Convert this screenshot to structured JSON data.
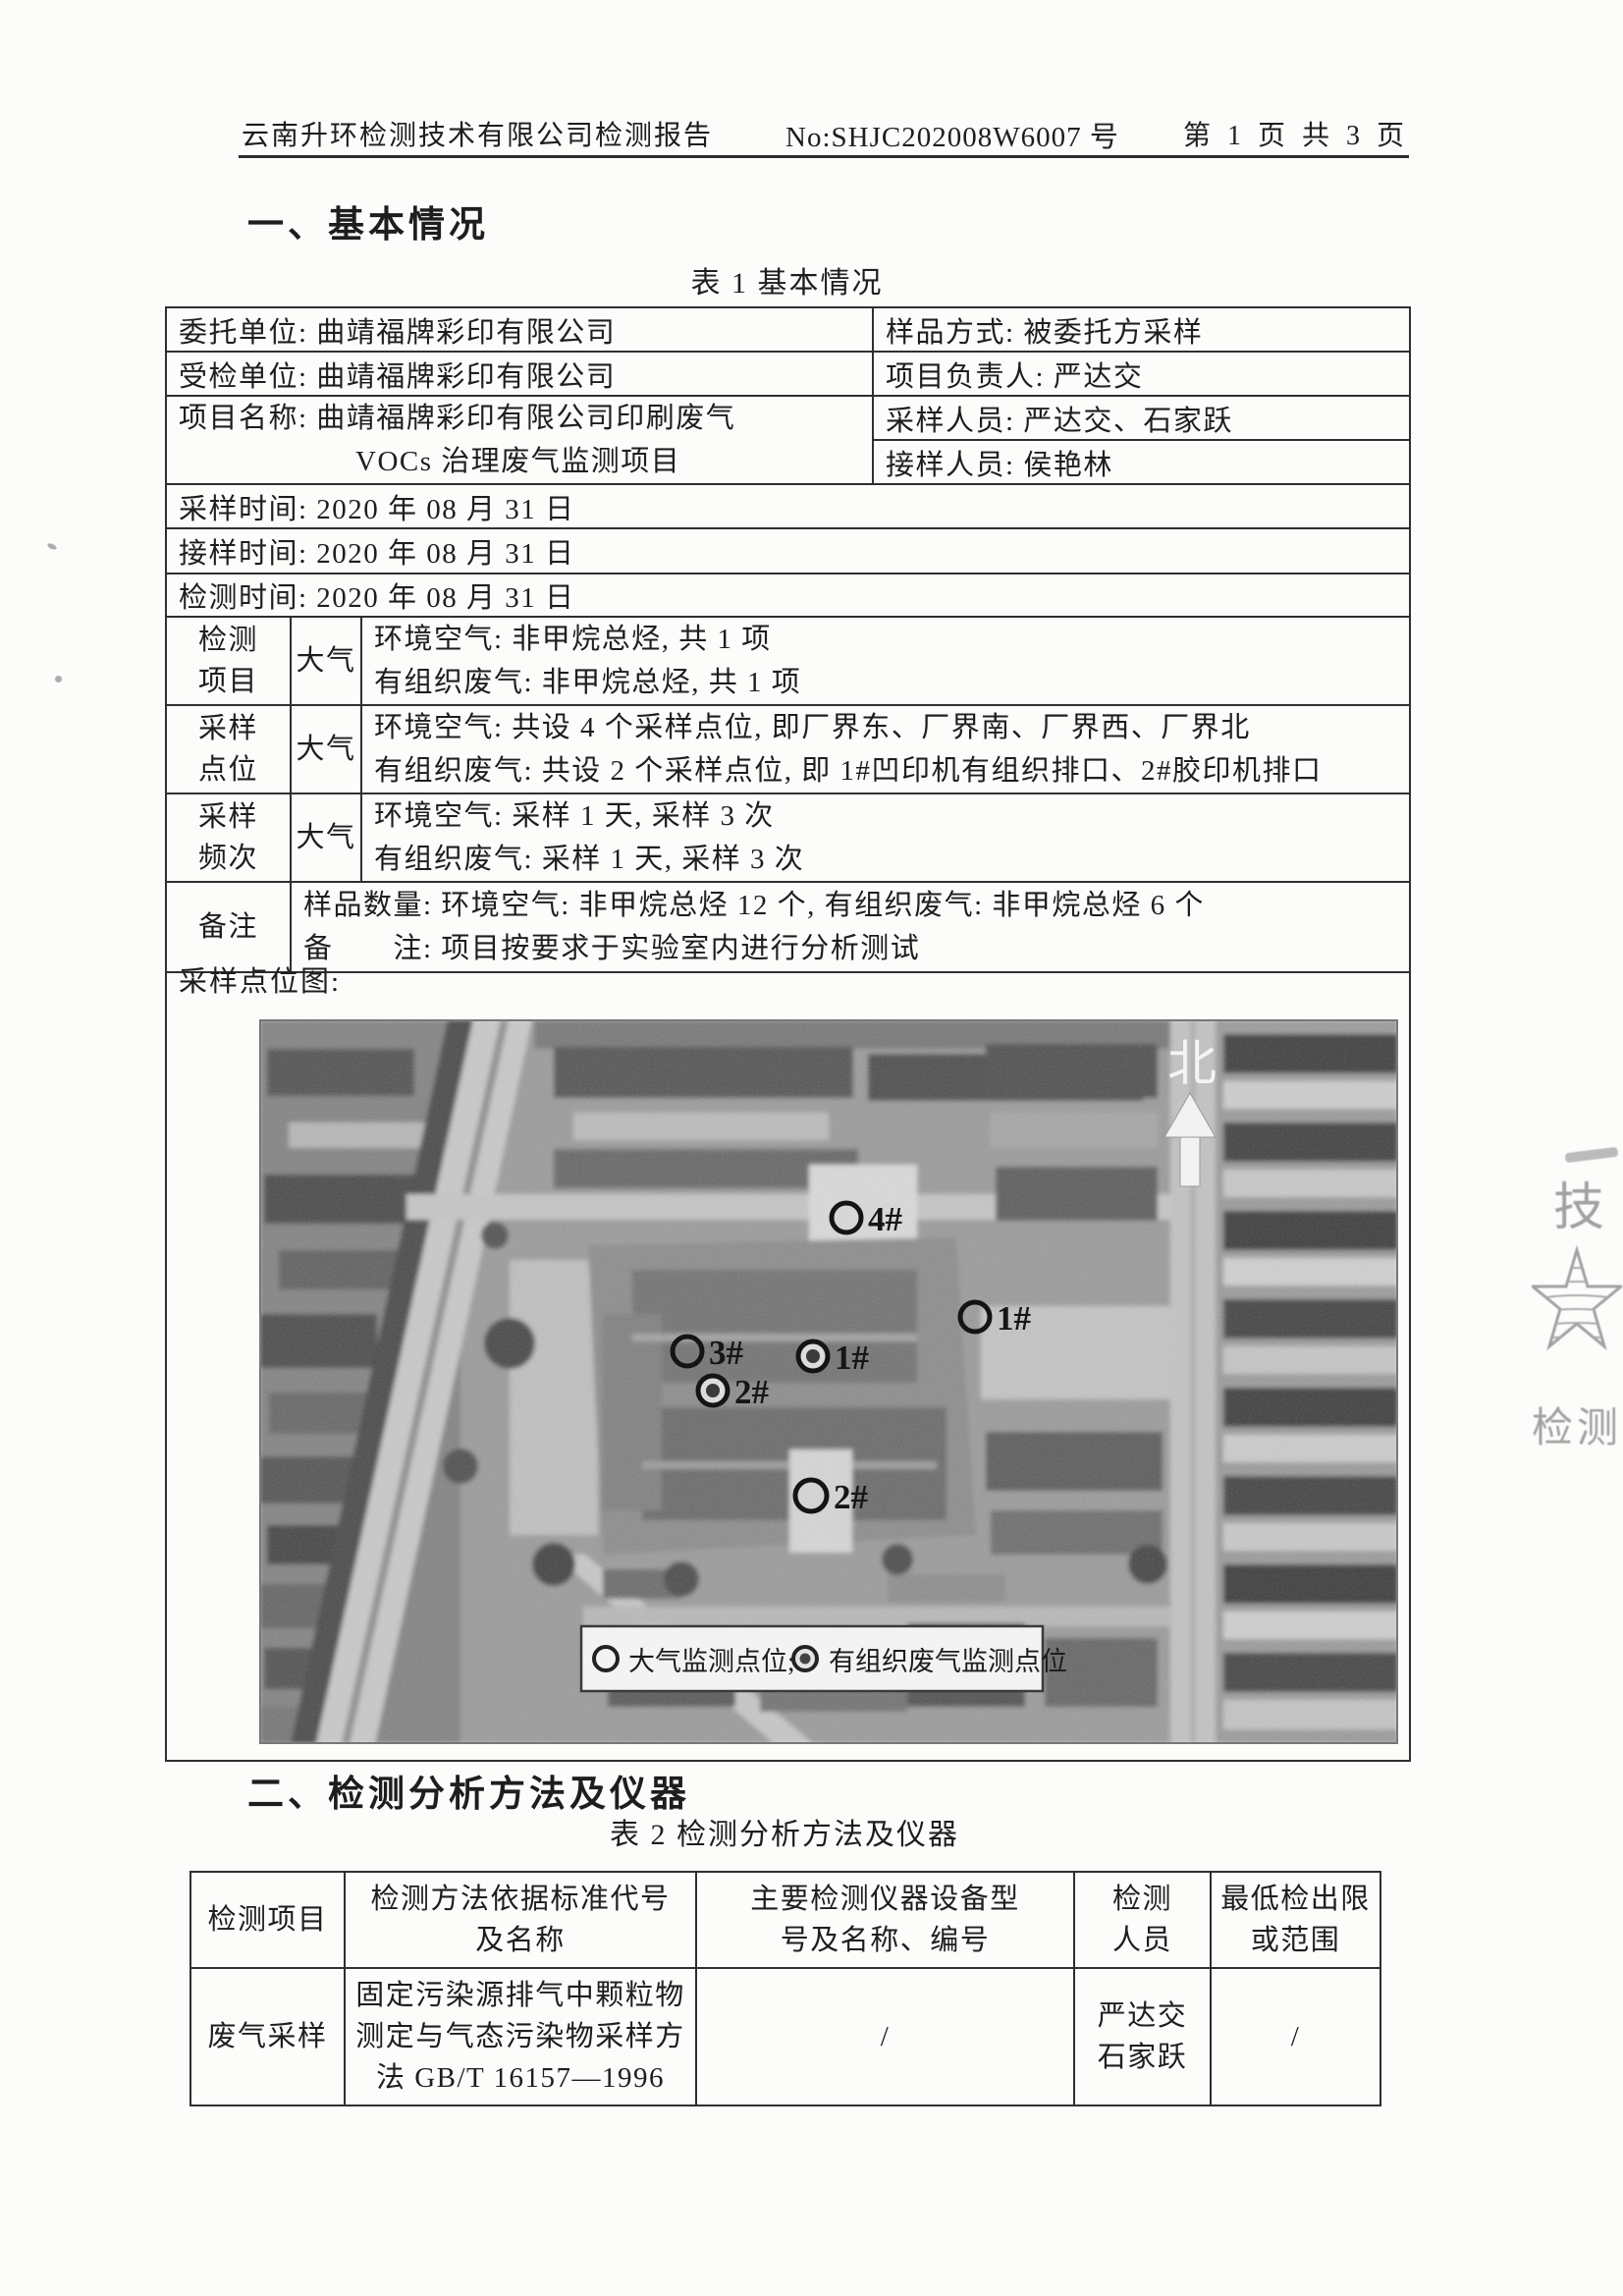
{
  "header": {
    "title": "云南升环检测技术有限公司检测报告",
    "report_no": "No:SHJC202008W6007 号",
    "page_info": "第 1 页 共 3 页"
  },
  "section1": {
    "heading": "一、基本情况",
    "table_caption": "表 1 基本情况"
  },
  "table1": {
    "client_unit": "委托单位: 曲靖福牌彩印有限公司",
    "sample_method": "样品方式: 被委托方采样",
    "inspected_unit": "受检单位: 曲靖福牌彩印有限公司",
    "project_leader": "项目负责人: 严达交",
    "project_name_line1": "项目名称: 曲靖福牌彩印有限公司印刷废气",
    "project_name_line2": "VOCs 治理废气监测项目",
    "sampling_staff": "采样人员: 严达交、石家跃",
    "receiving_staff": "接样人员: 侯艳林",
    "sampling_time": "采样时间: 2020 年 08 月 31 日",
    "receiving_time": "接样时间: 2020 年 08 月 31 日",
    "testing_time": "检测时间: 2020 年 08 月 31 日",
    "rows": [
      {
        "label": "检测\n项目",
        "category": "大气",
        "line1": "环境空气: 非甲烷总烃, 共 1 项",
        "line2": "有组织废气: 非甲烷总烃, 共 1 项"
      },
      {
        "label": "采样\n点位",
        "category": "大气",
        "line1": "环境空气: 共设 4 个采样点位, 即厂界东、厂界南、厂界西、厂界北",
        "line2": "有组织废气: 共设 2 个采样点位, 即 1#凹印机有组织排口、2#胶印机排口"
      },
      {
        "label": "采样\n频次",
        "category": "大气",
        "line1": "环境空气: 采样 1 天, 采样 3 次",
        "line2": "有组织废气: 采样 1 天, 采样 3 次"
      }
    ],
    "remark_label": "备注",
    "remark_line1": "样品数量: 环境空气: 非甲烷总烃 12 个, 有组织废气: 非甲烷总烃 6 个",
    "remark_line2": "备　　注: 项目按要求于实验室内进行分析测试",
    "map_label": "采样点位图:"
  },
  "map": {
    "north_label": "北",
    "legend": {
      "atmospheric": "大气监测点位;",
      "organized": "有组织废气监测点位"
    },
    "markers": [
      {
        "label": "4#",
        "type": "atmospheric"
      },
      {
        "label": "1#",
        "type": "atmospheric"
      },
      {
        "label": "3#",
        "type": "atmospheric"
      },
      {
        "label": "1#",
        "type": "organized"
      },
      {
        "label": "2#",
        "type": "organized"
      },
      {
        "label": "2#",
        "type": "atmospheric"
      }
    ]
  },
  "section2": {
    "heading": "二、检测分析方法及仪器",
    "table_caption": "表 2 检测分析方法及仪器"
  },
  "table2": {
    "headers": [
      "检测项目",
      "检测方法依据标准代号\n及名称",
      "主要检测仪器设备型\n号及名称、编号",
      "检测\n人员",
      "最低检出限\n或范围"
    ],
    "rows": [
      [
        "废气采样",
        "固定污染源排气中颗粒物\n测定与气态污染物采样方\n法 GB/T 16157—1996",
        "/",
        "严达交\n石家跃",
        "/"
      ]
    ]
  },
  "stamp": {
    "char_top": "技",
    "char_bottom": "检测"
  },
  "colors": {
    "ink": "#1e1e1e",
    "table_border": "#2f2f2f",
    "stamp_gray": "#9a9a9a",
    "page_bg": "#fcfcfa"
  }
}
